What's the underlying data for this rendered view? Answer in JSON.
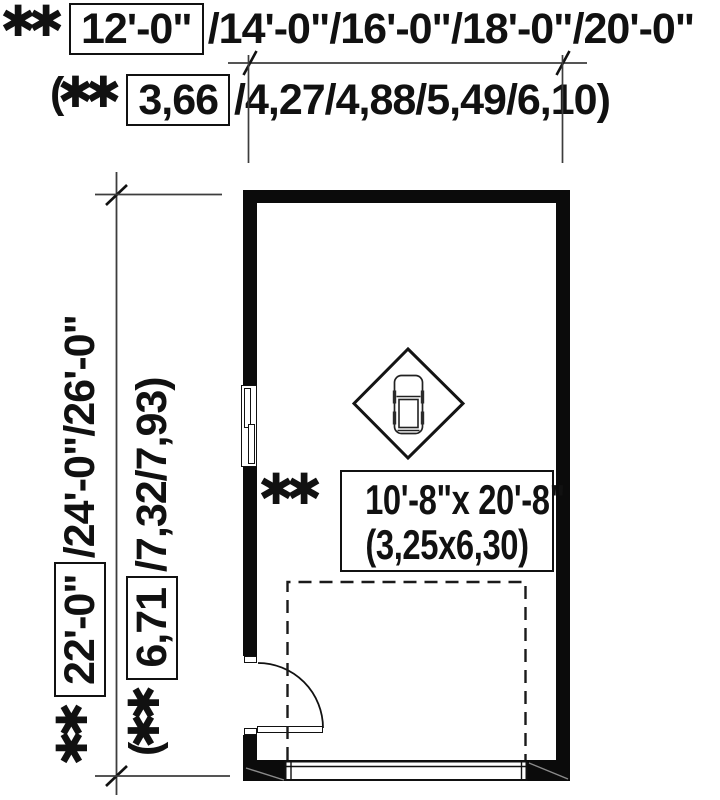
{
  "drawing_type": "garage floor plan with optional size dimensions",
  "width_dimension": {
    "asterisks": "✱ ✱",
    "feet_boxed": "12'-0\"",
    "feet_options": "/14'-0\"/16'-0\"/18'-0\"/20'-0\"",
    "meters_prefix": "(✱ ✱",
    "meters_boxed": "3,66",
    "meters_options": "/4,27/4,88/5,49/6,10)"
  },
  "depth_dimension": {
    "asterisks": "✱ ✱",
    "feet_boxed": "22'-0\"",
    "feet_options": "/24'-0\"/26'-0\"",
    "meters_prefix": "(✱ ✱",
    "meters_boxed": "6,71",
    "meters_options": "/7,32/7,93)"
  },
  "garage_label": {
    "asterisks": "✱ ✱",
    "imperial": "10'-8\"x 20'-8\"",
    "metric": "(3,25x6,30)"
  },
  "colors": {
    "ink": "#111111",
    "wall": "#0b0b0b",
    "dim_line": "#3d3d3d",
    "background": "#ffffff"
  }
}
